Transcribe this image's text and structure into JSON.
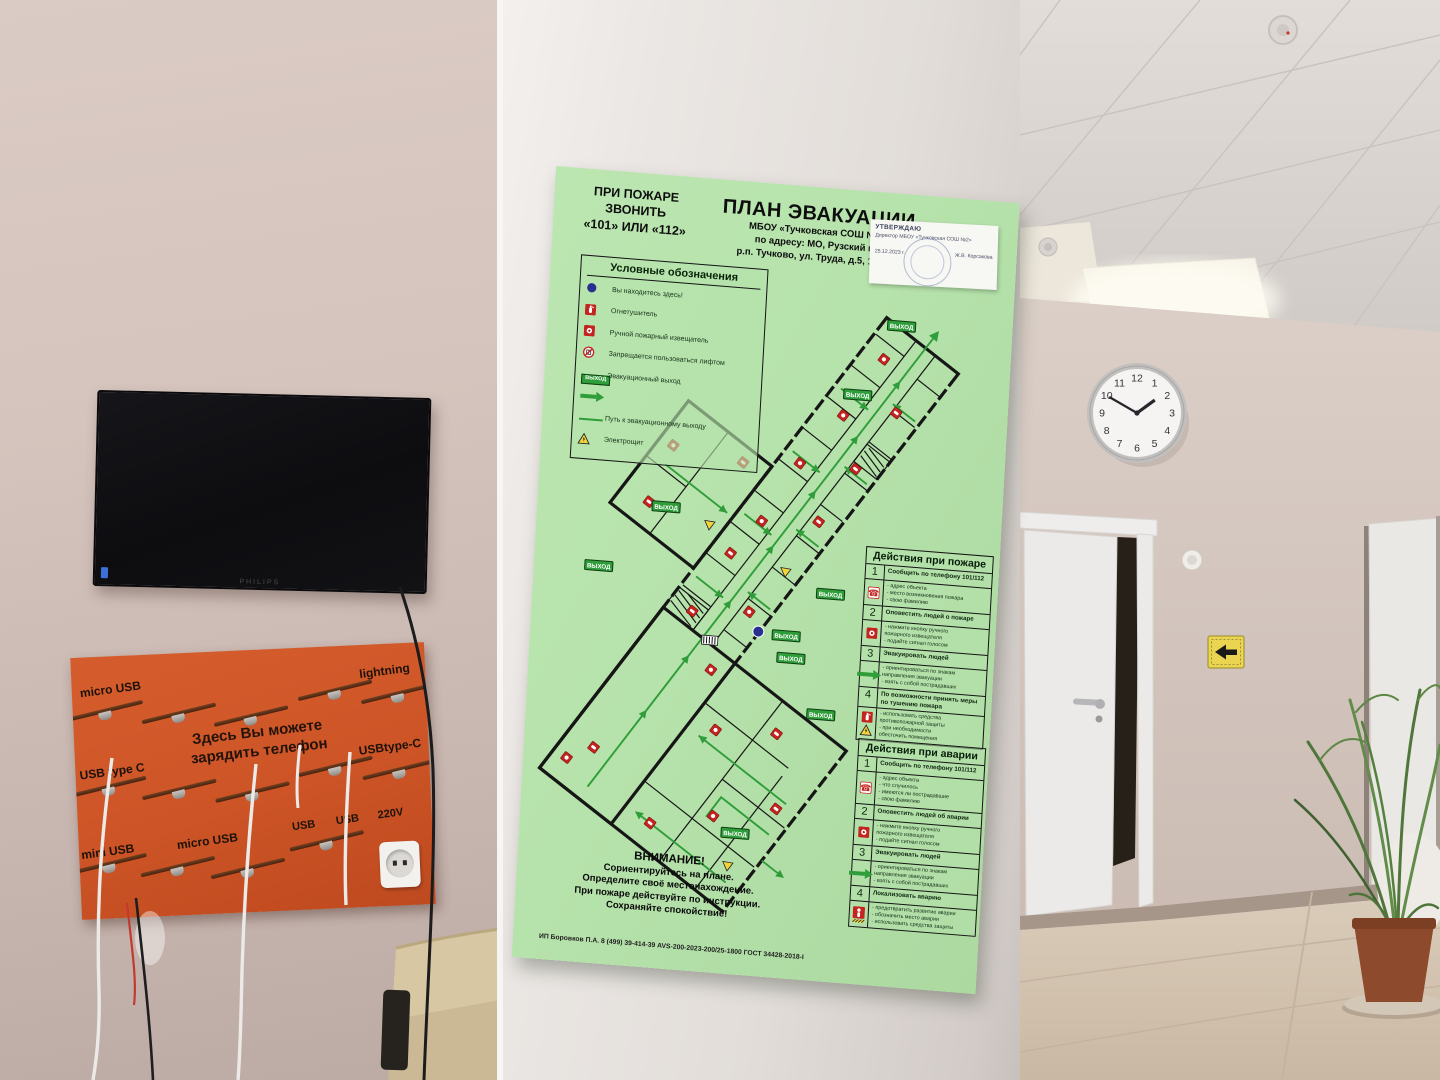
{
  "poster": {
    "emergency_call": [
      "ПРИ ПОЖАРЕ",
      "ЗВОНИТЬ",
      "«101» ИЛИ «112»"
    ],
    "title": "ПЛАН ЭВАКУАЦИИ",
    "subtitle": [
      "МБОУ «Тучковская СОШ №2»",
      "по адресу: МО, Рузский го,",
      "р.п. Тучково, ул. Труда, д.5, 1 этаж"
    ],
    "stamp": {
      "approve": "УТВЕРЖДАЮ",
      "line1": "Директор МБОУ «Тучковская СОШ №2»",
      "date": "25.12.2023 г.",
      "signature": "Ж.В. Корсакова"
    },
    "legend": {
      "title": "Условные обозначения",
      "items": [
        {
          "icon": "you-are-here",
          "label": "Вы находитесь здесь!"
        },
        {
          "icon": "fire-extinguisher",
          "label": "Огнетушитель"
        },
        {
          "icon": "manual-call-point",
          "label": "Ручной пожарный извещатель"
        },
        {
          "icon": "no-elevator",
          "label": "Запрещается пользоваться лифтом"
        },
        {
          "icon": "exit-sign",
          "label": "Эвакуационный выход"
        },
        {
          "icon": "route-arrow",
          "label": ""
        },
        {
          "icon": "route-line",
          "label": "Путь к эвакуационному выходу"
        },
        {
          "icon": "electrical-panel",
          "label": "Электрощит"
        }
      ]
    },
    "exit_label": "ВЫХОД",
    "plan": {
      "exits": [
        [
          354,
          132
        ],
        [
          314,
          204
        ],
        [
          129,
          331
        ],
        [
          65,
          395
        ],
        [
          298,
          405
        ],
        [
          256,
          450
        ],
        [
          262,
          472
        ],
        [
          295,
          526
        ],
        [
          216,
          651
        ]
      ],
      "you_are_here": [
        228,
        448
      ],
      "markers": [
        {
          "t": "mcp",
          "x": -60,
          "y": -30
        },
        {
          "t": "ext",
          "x": -35,
          "y": -15
        },
        {
          "t": "ext",
          "x": -60,
          "y": 75
        },
        {
          "t": "mcp",
          "x": -15,
          "y": 120
        },
        {
          "t": "ext",
          "x": 30,
          "y": 165
        },
        {
          "t": "tri",
          "x": -45,
          "y": 160
        },
        {
          "t": "mcp",
          "x": 55,
          "y": 70
        },
        {
          "t": "ext",
          "x": 90,
          "y": 120
        },
        {
          "t": "mcp",
          "x": 100,
          "y": 30
        },
        {
          "t": "ext",
          "x": 135,
          "y": -20
        },
        {
          "t": "mcp",
          "x": 170,
          "y": 25
        },
        {
          "t": "ext",
          "x": 205,
          "y": -25
        },
        {
          "t": "tri",
          "x": 225,
          "y": 28
        },
        {
          "t": "mcp",
          "x": 250,
          "y": -20
        },
        {
          "t": "ext",
          "x": 285,
          "y": 25
        },
        {
          "t": "mcp",
          "x": 320,
          "y": -25
        },
        {
          "t": "ext",
          "x": 350,
          "y": 22
        },
        {
          "t": "mcp",
          "x": 385,
          "y": -20
        },
        {
          "t": "ext",
          "x": 420,
          "y": 20
        },
        {
          "t": "mcp",
          "x": 455,
          "y": -22
        },
        {
          "t": "ext",
          "x": 195,
          "y": -120
        },
        {
          "t": "mcp",
          "x": 255,
          "y": -135
        },
        {
          "t": "ext",
          "x": 285,
          "y": -70
        },
        {
          "t": "tri",
          "x": 215,
          "y": -60
        }
      ]
    },
    "fire_actions": {
      "title": "Действия при пожаре",
      "steps": [
        {
          "num": "1",
          "action": "Сообщить по телефону 101/112",
          "icons": [
            "phone"
          ],
          "details": [
            "- адрес объекта",
            "- место возникновения пожара",
            "- свою фамилию"
          ]
        },
        {
          "num": "2",
          "action": "Оповестить людей о пожаре",
          "icons": [
            "manual-call-point"
          ],
          "details": [
            "- нажмите кнопку ручного",
            "  пожарного извещателя",
            "- подайте сигнал голосом"
          ]
        },
        {
          "num": "3",
          "action": "Эвакуировать людей",
          "icons": [
            "route-arrow"
          ],
          "details": [
            "- ориентироваться по знакам",
            "  направления эвакуации",
            "- взять с собой пострадавших"
          ]
        },
        {
          "num": "4",
          "action": "По возможности принять меры по тушению пожара",
          "icons": [
            "fire-extinguisher",
            "electrical-panel"
          ],
          "details": [
            "- использовать средства",
            "  противопожарной защиты",
            "- при необходимости",
            "  обесточить помещения"
          ]
        }
      ]
    },
    "accident_actions": {
      "title": "Действия при аварии",
      "steps": [
        {
          "num": "1",
          "action": "Сообщить по телефону 101/112",
          "icons": [
            "phone"
          ],
          "details": [
            "- адрес объекта",
            "- что случилось",
            "- имеются ли пострадавшие",
            "- свою фамилию"
          ]
        },
        {
          "num": "2",
          "action": "Оповестить людей об аварии",
          "icons": [
            "manual-call-point"
          ],
          "details": [
            "- нажмите кнопку ручного",
            "  пожарного извещателя",
            "- подайте сигнал голосом"
          ]
        },
        {
          "num": "3",
          "action": "Эвакуировать людей",
          "icons": [
            "route-arrow"
          ],
          "details": [
            "- ориентироваться по знакам",
            "  направления эвакуации",
            "- взять с собой пострадавших"
          ]
        },
        {
          "num": "4",
          "action": "Локализовать аварию",
          "icons": [
            "person-hazard"
          ],
          "details": [
            "- предотвратить развитие аварии",
            "- обозначить место аварии",
            "- использовать средства защиты"
          ]
        }
      ]
    },
    "attention": {
      "title": "ВНИМАНИЕ!",
      "lines": [
        "Сориентируйтесь на плане.",
        "Определите своё местонахождение.",
        "При пожаре действуйте по инструкции.",
        "Сохраняйте спокойствие!"
      ]
    },
    "footer": "ИП Боровков П.А. 8 (499) 39-414-39 AVS-200-2023-200/25-1800 ГОСТ 34428-2018-I"
  },
  "charging_station": {
    "heading": [
      "Здесь Вы можете",
      "зарядить телефон"
    ],
    "labels": [
      {
        "text": "micro USB",
        "x": 8,
        "y": 26,
        "size": 12
      },
      {
        "text": "lightning",
        "x": 288,
        "y": 20,
        "size": 12
      },
      {
        "text": "USB type C",
        "x": 4,
        "y": 108,
        "size": 12
      },
      {
        "text": "USBtype-C",
        "x": 284,
        "y": 96,
        "size": 12
      },
      {
        "text": "mini USB",
        "x": 2,
        "y": 188,
        "size": 12
      },
      {
        "text": "micro USB",
        "x": 98,
        "y": 182,
        "size": 12
      },
      {
        "text": "USB",
        "x": 214,
        "y": 172,
        "size": 11
      },
      {
        "text": "USB",
        "x": 258,
        "y": 168,
        "size": 11
      },
      {
        "text": "220V",
        "x": 300,
        "y": 164,
        "size": 11
      }
    ]
  },
  "tv": {
    "brand": "PHILIPS"
  },
  "hallway": {
    "clock": {
      "numerals": [
        "12",
        "1",
        "2",
        "3",
        "4",
        "5",
        "6",
        "7",
        "8",
        "9",
        "10",
        "11"
      ],
      "time": "13:50"
    },
    "arrow_sign": "left-arrow"
  }
}
